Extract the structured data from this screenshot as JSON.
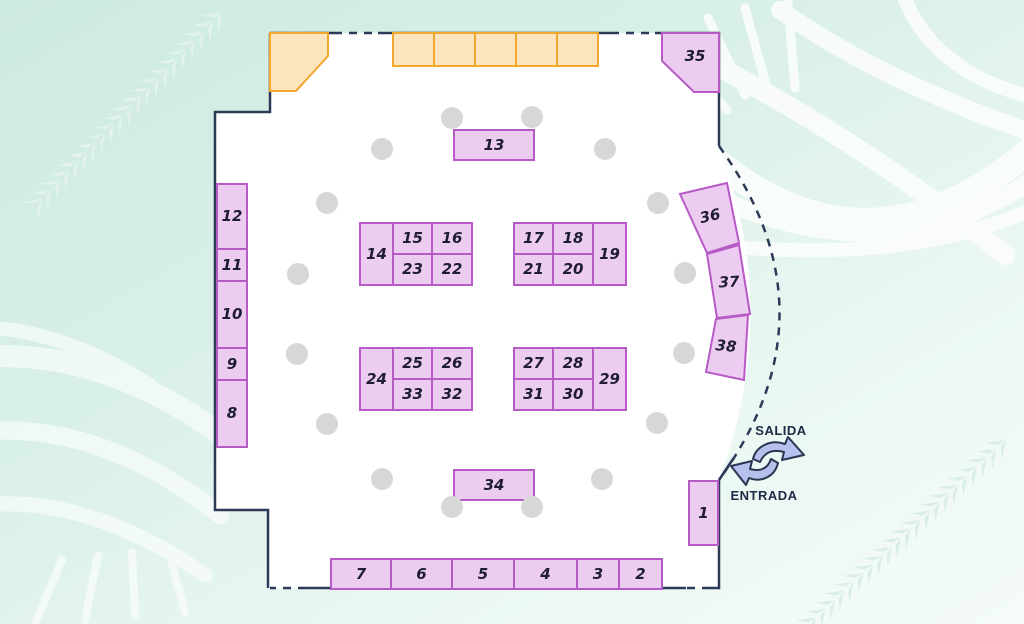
{
  "legend": {
    "exit_label": "SALIDA",
    "entrance_label": "ENTRADA"
  },
  "colors": {
    "background_mint": "#d7efe7",
    "floor": "#ffffff",
    "wall": "#2c3957",
    "booth_fill": "#ecccf0",
    "booth_border": "#b65ac6",
    "stand_orange_fill": "#fce5bc",
    "stand_orange_border": "#f4a72d",
    "column_dot": "#d7d7d7",
    "arrow_fill": "#b6c1ed",
    "arrow_outline": "#2a3550",
    "label_text": "#1d2945"
  },
  "booths": {
    "b1": {
      "label": "1"
    },
    "b2": {
      "label": "2"
    },
    "b3": {
      "label": "3"
    },
    "b4": {
      "label": "4"
    },
    "b5": {
      "label": "5"
    },
    "b6": {
      "label": "6"
    },
    "b7": {
      "label": "7"
    },
    "b8": {
      "label": "8"
    },
    "b9": {
      "label": "9"
    },
    "b10": {
      "label": "10"
    },
    "b11": {
      "label": "11"
    },
    "b12": {
      "label": "12"
    },
    "b13": {
      "label": "13"
    },
    "b14": {
      "label": "14"
    },
    "b15": {
      "label": "15"
    },
    "b16": {
      "label": "16"
    },
    "b17": {
      "label": "17"
    },
    "b18": {
      "label": "18"
    },
    "b19": {
      "label": "19"
    },
    "b20": {
      "label": "20"
    },
    "b21": {
      "label": "21"
    },
    "b22": {
      "label": "22"
    },
    "b23": {
      "label": "23"
    },
    "b24": {
      "label": "24"
    },
    "b25": {
      "label": "25"
    },
    "b26": {
      "label": "26"
    },
    "b27": {
      "label": "27"
    },
    "b28": {
      "label": "28"
    },
    "b29": {
      "label": "29"
    },
    "b30": {
      "label": "30"
    },
    "b31": {
      "label": "31"
    },
    "b32": {
      "label": "32"
    },
    "b33": {
      "label": "33"
    },
    "b34": {
      "label": "34"
    },
    "b35": {
      "label": "35"
    },
    "b36": {
      "label": "36"
    },
    "b37": {
      "label": "37"
    },
    "b38": {
      "label": "38"
    }
  }
}
